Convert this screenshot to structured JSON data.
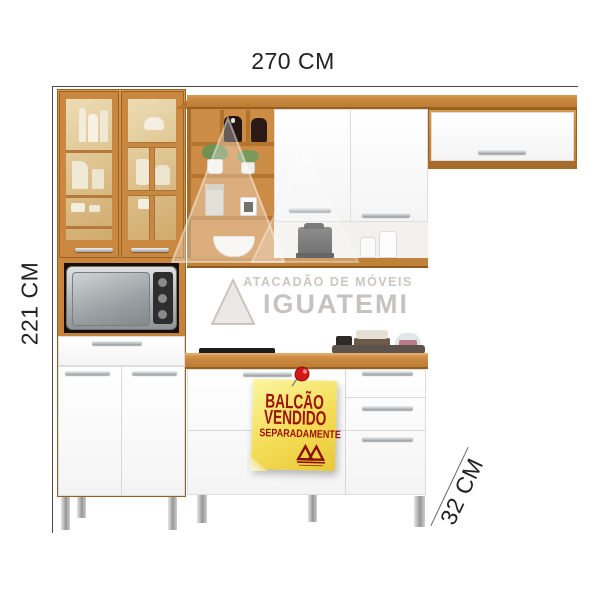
{
  "scene": {
    "description": "Kitchen cabinet set product photo: left tall cabinet with glass doors and microwave niche, upper wall cabinets with open shelving, base counter with cooktop and drawers"
  },
  "dimensions": {
    "width_label": "270 CM",
    "height_label": "221 CM",
    "depth_label": "32 CM"
  },
  "sticky_note": {
    "line1": "BALCÃO",
    "line2": "VENDIDO",
    "line3": "SEPARADAMENTE",
    "note_color": "#f3dc55",
    "text_color": "#9b130c"
  },
  "watermark": {
    "line1": "ATACADÃO DE MÓVEIS",
    "line2": "IGUATEMI"
  },
  "colors": {
    "wood": "#c9873f",
    "wood_dark": "#a86c2a",
    "cabinet_white": "#fbfbfb",
    "dimension_text": "#222222",
    "background": "#ffffff"
  }
}
